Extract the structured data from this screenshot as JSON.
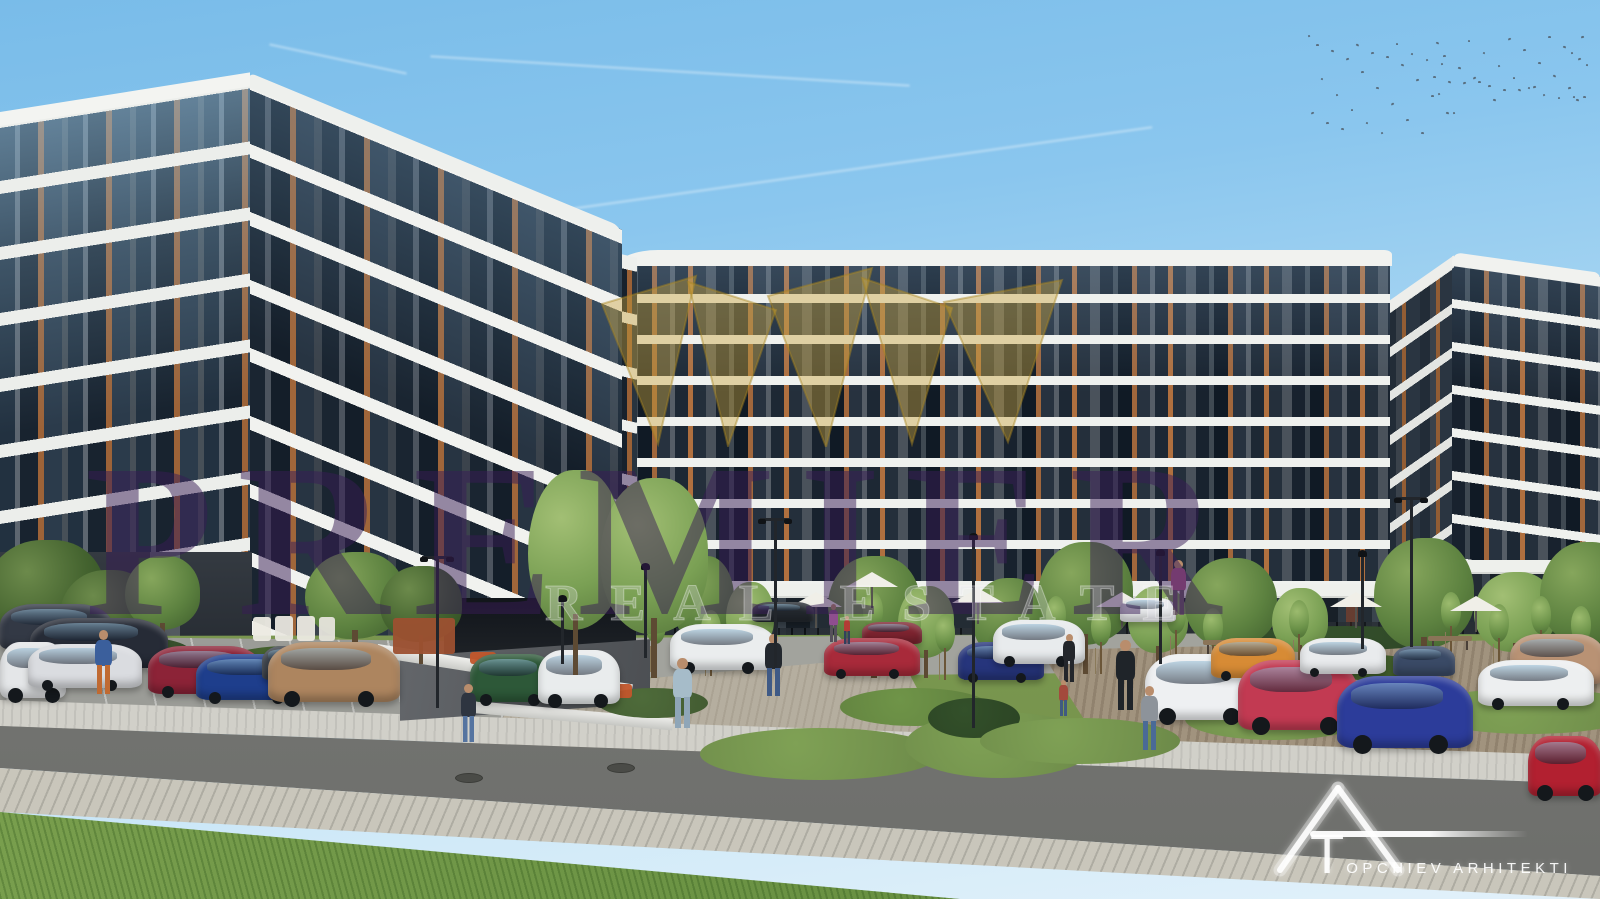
{
  "image": {
    "type": "architectural exterior render",
    "subject": "modern multi-storey apartment complex with landscaped parking and street"
  },
  "watermark": {
    "brand": "PREMIER",
    "tagline": "REAL ESTATE",
    "crown_icon": "gold-crown",
    "brand_color": "#3a1c56",
    "tagline_color": "#f5f0fa",
    "crown_color": "#c9a23b"
  },
  "logo": {
    "text": "TOPCHIEV ARHITEKTI",
    "mark": "triangle-A-with-T-monogram",
    "color": "#ffffff"
  },
  "palette": {
    "sky_top": "#79bce9",
    "sky_horizon": "#e2f1fa",
    "facade_dark": "#3d434b",
    "balcony_band": "#f1f2ef",
    "wood_accent": "#a0663a",
    "glass": "#18222e",
    "glass_reflection": "#96c3e1",
    "grass": "#7d9b58",
    "asphalt": "#777875",
    "paver": "#c9c6bb",
    "gravel": "#b5ae9f"
  },
  "buildings": [
    {
      "name": "left-tower",
      "floors": 8,
      "style": "dark grey facade, wavy white balcony bands, wood window accents"
    },
    {
      "name": "center-block",
      "floors": 8,
      "style": "long slab with ground-floor retail terrace and umbrellas"
    },
    {
      "name": "right-block",
      "floors": 8,
      "style": "matching corner block at right edge"
    }
  ],
  "scene": {
    "contrails": [
      {
        "x": 430,
        "y": 70,
        "w": 480,
        "angle": 3.5
      },
      {
        "x": 555,
        "y": 168,
        "w": 600,
        "angle": -8
      },
      {
        "x": 268,
        "y": 58,
        "w": 140,
        "angle": 12
      }
    ],
    "birds": {
      "x": 1308,
      "y": 35,
      "w": 280,
      "h": 102,
      "count": 64
    },
    "vehicles": [
      {
        "x": 0,
        "y": 604,
        "w": 112,
        "h": 46,
        "c": "#333945"
      },
      {
        "x": 30,
        "y": 618,
        "w": 138,
        "h": 50,
        "c": "#262b36"
      },
      {
        "x": 0,
        "y": 642,
        "w": 66,
        "h": 56,
        "c": "#e4e6e8"
      },
      {
        "x": 28,
        "y": 644,
        "w": 114,
        "h": 44,
        "c": "#dadce0"
      },
      {
        "x": 148,
        "y": 646,
        "w": 114,
        "h": 48,
        "c": "#8c2337"
      },
      {
        "x": 196,
        "y": 654,
        "w": 112,
        "h": 46,
        "c": "#1e3e8c"
      },
      {
        "x": 262,
        "y": 646,
        "w": 62,
        "h": 34,
        "c": "#3a4049"
      },
      {
        "x": 268,
        "y": 642,
        "w": 132,
        "h": 60,
        "c": "#ad855f"
      },
      {
        "x": 470,
        "y": 654,
        "w": 86,
        "h": 48,
        "c": "#2d5838"
      },
      {
        "x": 538,
        "y": 650,
        "w": 82,
        "h": 54,
        "c": "#e9eced"
      },
      {
        "x": 670,
        "y": 624,
        "w": 106,
        "h": 46,
        "c": "#eaedee"
      },
      {
        "x": 752,
        "y": 602,
        "w": 62,
        "h": 20,
        "c": "#23282e"
      },
      {
        "x": 862,
        "y": 622,
        "w": 60,
        "h": 22,
        "c": "#7e2430"
      },
      {
        "x": 824,
        "y": 638,
        "w": 96,
        "h": 38,
        "c": "#a82a3a"
      },
      {
        "x": 958,
        "y": 642,
        "w": 86,
        "h": 38,
        "c": "#26357c"
      },
      {
        "x": 993,
        "y": 620,
        "w": 92,
        "h": 44,
        "c": "#e8ebed"
      },
      {
        "x": 1120,
        "y": 598,
        "w": 56,
        "h": 24,
        "c": "#e8eaec"
      },
      {
        "x": 1145,
        "y": 654,
        "w": 114,
        "h": 66,
        "c": "#eef0f2"
      },
      {
        "x": 1211,
        "y": 638,
        "w": 84,
        "h": 40,
        "c": "#d78b35"
      },
      {
        "x": 1238,
        "y": 660,
        "w": 120,
        "h": 70,
        "c": "#c23a52"
      },
      {
        "x": 1300,
        "y": 638,
        "w": 86,
        "h": 36,
        "c": "#e9ebed"
      },
      {
        "x": 1393,
        "y": 646,
        "w": 62,
        "h": 30,
        "c": "#3a4a66"
      },
      {
        "x": 1510,
        "y": 634,
        "w": 95,
        "h": 50,
        "c": "#b99274"
      },
      {
        "x": 1478,
        "y": 660,
        "w": 116,
        "h": 46,
        "c": "#edeff0"
      },
      {
        "x": 1337,
        "y": 676,
        "w": 136,
        "h": 72,
        "c": "#2c3c9a"
      },
      {
        "x": 1528,
        "y": 736,
        "w": 74,
        "h": 60,
        "c": "#b22030"
      }
    ],
    "trees": [
      {
        "x": -15,
        "y": 540,
        "w": 120,
        "h": 135,
        "tone": "dark"
      },
      {
        "x": 60,
        "y": 570,
        "w": 95,
        "h": 110,
        "tone": "dark"
      },
      {
        "x": 125,
        "y": 556,
        "w": 75,
        "h": 95,
        "tone": "mid"
      },
      {
        "x": 305,
        "y": 552,
        "w": 100,
        "h": 112,
        "tone": "mid"
      },
      {
        "x": 380,
        "y": 566,
        "w": 82,
        "h": 98,
        "tone": "dark"
      },
      {
        "x": 672,
        "y": 556,
        "w": 62,
        "h": 112,
        "tone": "mid"
      },
      {
        "x": 726,
        "y": 582,
        "w": 48,
        "h": 88,
        "tone": "light"
      },
      {
        "x": 828,
        "y": 556,
        "w": 92,
        "h": 122,
        "tone": "mid"
      },
      {
        "x": 898,
        "y": 586,
        "w": 56,
        "h": 92,
        "tone": "light"
      },
      {
        "x": 972,
        "y": 578,
        "w": 72,
        "h": 102,
        "tone": "mid"
      },
      {
        "x": 1038,
        "y": 542,
        "w": 95,
        "h": 132,
        "tone": "mid"
      },
      {
        "x": 1128,
        "y": 586,
        "w": 60,
        "h": 86,
        "tone": "light"
      },
      {
        "x": 1185,
        "y": 558,
        "w": 92,
        "h": 116,
        "tone": "mid"
      },
      {
        "x": 1272,
        "y": 588,
        "w": 56,
        "h": 82,
        "tone": "light"
      },
      {
        "x": 1374,
        "y": 538,
        "w": 100,
        "h": 142,
        "tone": "mid"
      },
      {
        "x": 1474,
        "y": 572,
        "w": 82,
        "h": 102,
        "tone": "light"
      },
      {
        "x": 1540,
        "y": 542,
        "w": 92,
        "h": 132,
        "tone": "mid"
      },
      {
        "x": 528,
        "y": 470,
        "w": 95,
        "h": 205,
        "tone": "light",
        "front": true
      },
      {
        "x": 600,
        "y": 478,
        "w": 108,
        "h": 200,
        "tone": "light",
        "front": true
      }
    ],
    "bushes": [
      {
        "x": 60,
        "y": 636,
        "w": 130,
        "h": 30,
        "c": "#3f5a33"
      },
      {
        "x": 230,
        "y": 646,
        "w": 120,
        "h": 26,
        "c": "#46642f"
      },
      {
        "x": 510,
        "y": 662,
        "w": 95,
        "h": 26,
        "c": "#3f5a33"
      },
      {
        "x": 598,
        "y": 688,
        "w": 110,
        "h": 30,
        "c": "#4e6b3a"
      },
      {
        "x": 700,
        "y": 728,
        "w": 240,
        "h": 52,
        "c": "#7fa155"
      },
      {
        "x": 840,
        "y": 688,
        "w": 150,
        "h": 38,
        "c": "#6f9448"
      },
      {
        "x": 905,
        "y": 712,
        "w": 190,
        "h": 66,
        "c": "#7fa155"
      },
      {
        "x": 928,
        "y": 698,
        "w": 92,
        "h": 40,
        "c": "#33502a"
      },
      {
        "x": 980,
        "y": 718,
        "w": 200,
        "h": 46,
        "c": "#7fa155"
      },
      {
        "x": 1185,
        "y": 698,
        "w": 180,
        "h": 42,
        "c": "#7fa155"
      },
      {
        "x": 1420,
        "y": 688,
        "w": 220,
        "h": 46,
        "c": "#7fa155"
      },
      {
        "x": 1240,
        "y": 626,
        "w": 210,
        "h": 24,
        "c": "#35512c"
      },
      {
        "x": 1500,
        "y": 622,
        "w": 170,
        "h": 24,
        "c": "#35512c"
      },
      {
        "x": 1330,
        "y": 655,
        "w": 90,
        "h": 26,
        "c": "#46642f"
      }
    ],
    "saplings": [
      {
        "x": 645,
        "y": 606
      },
      {
        "x": 700,
        "y": 610
      },
      {
        "x": 862,
        "y": 592
      },
      {
        "x": 900,
        "y": 604
      },
      {
        "x": 934,
        "y": 614
      },
      {
        "x": 1045,
        "y": 596
      },
      {
        "x": 1090,
        "y": 608
      },
      {
        "x": 1165,
        "y": 596
      },
      {
        "x": 1202,
        "y": 608
      },
      {
        "x": 1288,
        "y": 600
      },
      {
        "x": 1440,
        "y": 592
      },
      {
        "x": 1488,
        "y": 604
      },
      {
        "x": 1530,
        "y": 596
      },
      {
        "x": 1570,
        "y": 606
      }
    ],
    "people": [
      {
        "x": 94,
        "y": 630,
        "h": 64,
        "t": "#3b5f9c",
        "l": "#c06a32"
      },
      {
        "x": 460,
        "y": 684,
        "h": 58,
        "t": "#2e3540",
        "l": "#5574a0"
      },
      {
        "x": 672,
        "y": 658,
        "h": 70,
        "t": "#a6bcc9",
        "l": "#8fa6b8"
      },
      {
        "x": 764,
        "y": 634,
        "h": 62,
        "t": "#23282e",
        "l": "#3f5a86"
      },
      {
        "x": 828,
        "y": 604,
        "h": 38,
        "t": "#8f4e8f",
        "l": "#55505a"
      },
      {
        "x": 843,
        "y": 616,
        "h": 28,
        "t": "#b23b35",
        "l": "#32405c"
      },
      {
        "x": 1062,
        "y": 634,
        "h": 48,
        "t": "#23262b",
        "l": "#23262b"
      },
      {
        "x": 1058,
        "y": 680,
        "h": 36,
        "t": "#a34a3c",
        "l": "#405a80"
      },
      {
        "x": 1115,
        "y": 640,
        "h": 70,
        "t": "#1f2429",
        "l": "#1f2429"
      },
      {
        "x": 1140,
        "y": 686,
        "h": 64,
        "t": "#8d939a",
        "l": "#4a6a96"
      },
      {
        "x": 1170,
        "y": 560,
        "h": 55,
        "t": "#b05a8a",
        "l": "#6a5a64"
      }
    ],
    "lamps": [
      {
        "x": 420,
        "y": 556,
        "h": 152,
        "arm": true
      },
      {
        "x": 545,
        "y": 598,
        "h": 66
      },
      {
        "x": 628,
        "y": 566,
        "h": 92
      },
      {
        "x": 758,
        "y": 518,
        "h": 150,
        "arm": true
      },
      {
        "x": 956,
        "y": 536,
        "h": 192
      },
      {
        "x": 1143,
        "y": 552,
        "h": 112
      },
      {
        "x": 1345,
        "y": 553,
        "h": 96
      },
      {
        "x": 1394,
        "y": 497,
        "h": 150,
        "arm": true
      }
    ],
    "benches": [
      {
        "x": 698,
        "y": 652
      },
      {
        "x": 960,
        "y": 666
      },
      {
        "x": 1203,
        "y": 640
      },
      {
        "x": 1428,
        "y": 636
      }
    ],
    "umbrellas": [
      {
        "x": 846,
        "y": 572
      },
      {
        "x": 790,
        "y": 592
      },
      {
        "x": 952,
        "y": 588
      },
      {
        "x": 1096,
        "y": 592
      },
      {
        "x": 1330,
        "y": 592
      },
      {
        "x": 1450,
        "y": 596
      }
    ],
    "props": [
      {
        "x": 253,
        "y": 617,
        "w": 18,
        "h": 24,
        "c": "#eceae2",
        "name": "terrace-chair"
      },
      {
        "x": 275,
        "y": 616,
        "w": 18,
        "h": 25,
        "c": "#e9e7df",
        "name": "terrace-chair"
      },
      {
        "x": 297,
        "y": 616,
        "w": 18,
        "h": 25,
        "c": "#eceae2",
        "name": "terrace-chair"
      },
      {
        "x": 319,
        "y": 617,
        "w": 16,
        "h": 24,
        "c": "#e6e4dc",
        "name": "terrace-chair"
      },
      {
        "x": 393,
        "y": 618,
        "w": 62,
        "h": 36,
        "c": "#9c5030",
        "name": "pergola"
      },
      {
        "x": 470,
        "y": 652,
        "w": 26,
        "h": 12,
        "c": "#c2562b",
        "name": "flower-planter"
      },
      {
        "x": 592,
        "y": 684,
        "w": 40,
        "h": 14,
        "c": "#c2562b",
        "name": "flower-planter"
      }
    ],
    "manholes": [
      {
        "x": 455,
        "y": 773
      },
      {
        "x": 607,
        "y": 763
      }
    ]
  }
}
